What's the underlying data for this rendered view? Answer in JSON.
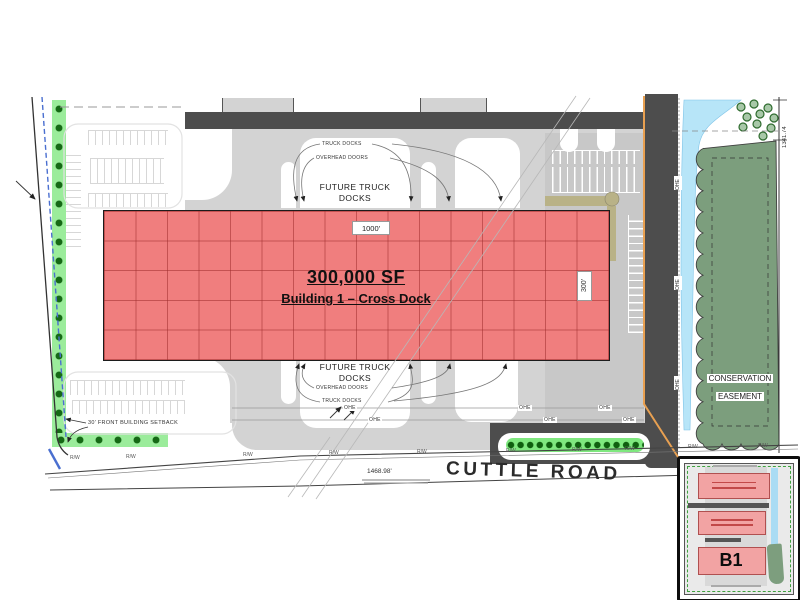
{
  "site": {
    "road_name": "CUTTLE ROAD",
    "road_frontage_dim": "1468.98'",
    "east_boundary_dim": "1341.74",
    "rw_abbrev": "R/W",
    "ohe_abbrev": "OHE"
  },
  "building": {
    "area": "300,000 SF",
    "name": "Building 1 – Cross Dock",
    "length": "1000'",
    "depth": "300'"
  },
  "annotations": {
    "truck_docks": "TRUCK DOCKS",
    "overhead_doors": "OVERHEAD DOORS",
    "future_truck_docks": "FUTURE TRUCK DOCKS",
    "setback": "30' FRONT BUILDING SETBACK",
    "conservation_line1": "CONSERVATION",
    "conservation_line2": "EASEMENT"
  },
  "inset": {
    "building_label": "B1"
  },
  "colors": {
    "building_fill": "#F07E7E",
    "road_fill": "#4D4D4D",
    "apron_fill": "#D3D3D3",
    "landscape_green": "#9BEC9B",
    "conservation_green": "#7C9E7D",
    "water_blue": "#B7E5F8",
    "pipeline_orange": "#E8A051",
    "boundary_blue": "#4A6FD0",
    "inset_building_fill": "#F2A3A3"
  }
}
